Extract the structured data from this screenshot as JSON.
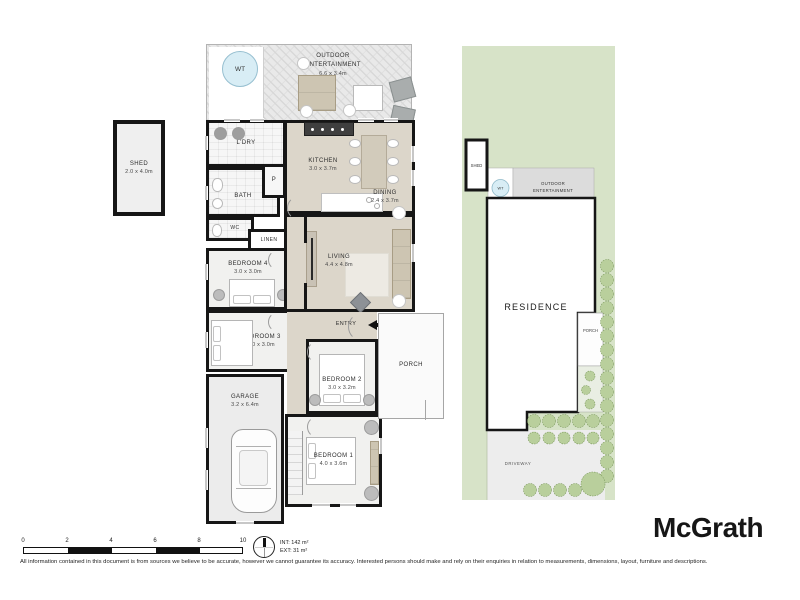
{
  "brand": {
    "logo_text": "McGrath"
  },
  "footer": {
    "disclaimer": "All information contained in this document is from sources we believe to be accurate, however we cannot guarantee its accuracy. Interested persons should make and rely on their enquiries in relation to measurements, dimensions, layout, furniture and descriptions."
  },
  "scalebar": {
    "ticks": [
      "0",
      "2",
      "4",
      "6",
      "8",
      "10"
    ]
  },
  "areas": {
    "internal": "INT: 142 m²",
    "external": "EXT: 31 m²"
  },
  "shed_detail": {
    "label": "SHED",
    "dims": "2.0 x 4.0m"
  },
  "floorplan": {
    "outdoor": {
      "line1": "OUTDOOR",
      "line2": "ENTERTAINMENT",
      "dims": "6.6 x 3.4m",
      "water_tank": "WT"
    },
    "laundry": {
      "label": "L'DRY"
    },
    "bath": {
      "label": "BATH"
    },
    "pantry": {
      "label": "P"
    },
    "wc": {
      "label": "WC"
    },
    "linen": {
      "label": "LINEN"
    },
    "kitchen": {
      "label": "KITCHEN",
      "dims": "3.0 x 3.7m"
    },
    "dining": {
      "label": "DINING",
      "dims": "2.4 x 3.7m"
    },
    "living": {
      "label": "LIVING",
      "dims": "4.4 x 4.8m"
    },
    "entry": {
      "label": "ENTRY"
    },
    "porch": {
      "label": "PORCH"
    },
    "bedroom1": {
      "label": "BEDROOM 1",
      "dims": "4.0 x 3.6m"
    },
    "bedroom2": {
      "label": "BEDROOM 2",
      "dims": "3.0 x 3.2m"
    },
    "bedroom3": {
      "label": "BEDROOM 3",
      "dims": "3.0 x 3.0m"
    },
    "bedroom4": {
      "label": "BEDROOM 4",
      "dims": "3.0 x 3.0m"
    },
    "garage": {
      "label": "GARAGE",
      "dims": "3.2 x 6.4m"
    }
  },
  "siteplan": {
    "shed": "SHED",
    "water_tank": "WT",
    "outdoor_line1": "OUTDOOR",
    "outdoor_line2": "ENTERTAINMENT",
    "residence": "RESIDENCE",
    "porch": "PORCH",
    "driveway": "DRIVEWAY"
  },
  "colors": {
    "wall": "#161616",
    "floor_beige": "#dcd6ca",
    "lot_green": "#d7e3c8",
    "shrub_green": "#b9cf9c",
    "water_blue": "#d8edf5"
  }
}
